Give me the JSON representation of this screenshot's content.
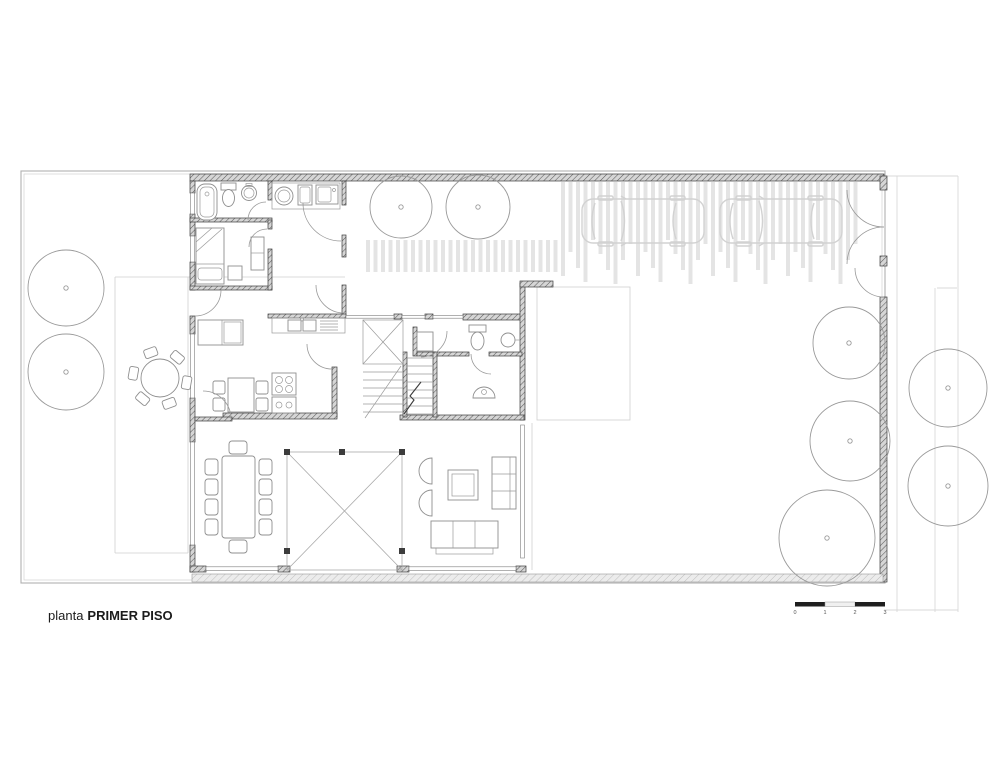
{
  "title": {
    "prefix": "planta",
    "name": "PRIMER PISO"
  },
  "scale_bar": {
    "tick_labels": [
      "0",
      "1",
      "2",
      "3"
    ]
  },
  "colors": {
    "paper": "#ffffff",
    "wall_dark": "#3c3c3c",
    "wall_hatch_bg": "#d6d6d6",
    "line_medium": "#8f8f8f",
    "door_arc": "#999999",
    "faint_line": "#d9d9d9",
    "paving_stripe": "#e4e4e4",
    "car_outline": "#d2d2d2",
    "tree_outline": "#9a9a9a",
    "scale_dark": "#1f1f1f",
    "text": "#1c1c1c"
  },
  "trees": {
    "garden": [
      {
        "cx": 66,
        "cy": 288,
        "r": 38
      },
      {
        "cx": 66,
        "cy": 372,
        "r": 38
      },
      {
        "cx": 401,
        "cy": 207,
        "r": 31
      },
      {
        "cx": 478,
        "cy": 207,
        "r": 32
      },
      {
        "cx": 849,
        "cy": 343,
        "r": 36
      },
      {
        "cx": 850,
        "cy": 441,
        "r": 40
      },
      {
        "cx": 827,
        "cy": 538,
        "r": 48
      }
    ],
    "street": [
      {
        "cx": 948,
        "cy": 388,
        "r": 39
      },
      {
        "cx": 948,
        "cy": 486,
        "r": 40
      }
    ]
  },
  "cars": [
    {
      "x": 580,
      "y": 194
    },
    {
      "x": 718,
      "y": 194
    }
  ],
  "paving": {
    "x_start": 368,
    "x_end": 858,
    "spacing": 7.5,
    "split_x": 560,
    "short_band": {
      "y0": 240,
      "y1": 272
    },
    "tall_band": {
      "y0": 182,
      "heights": [
        58,
        72,
        88,
        102,
        78,
        62,
        94,
        70,
        86,
        100
      ]
    }
  },
  "patio_table": {
    "cx": 160,
    "cy": 378,
    "radius": 19,
    "chair_distance": 27,
    "chair_angles": [
      10,
      70,
      130,
      190,
      250,
      310
    ]
  }
}
